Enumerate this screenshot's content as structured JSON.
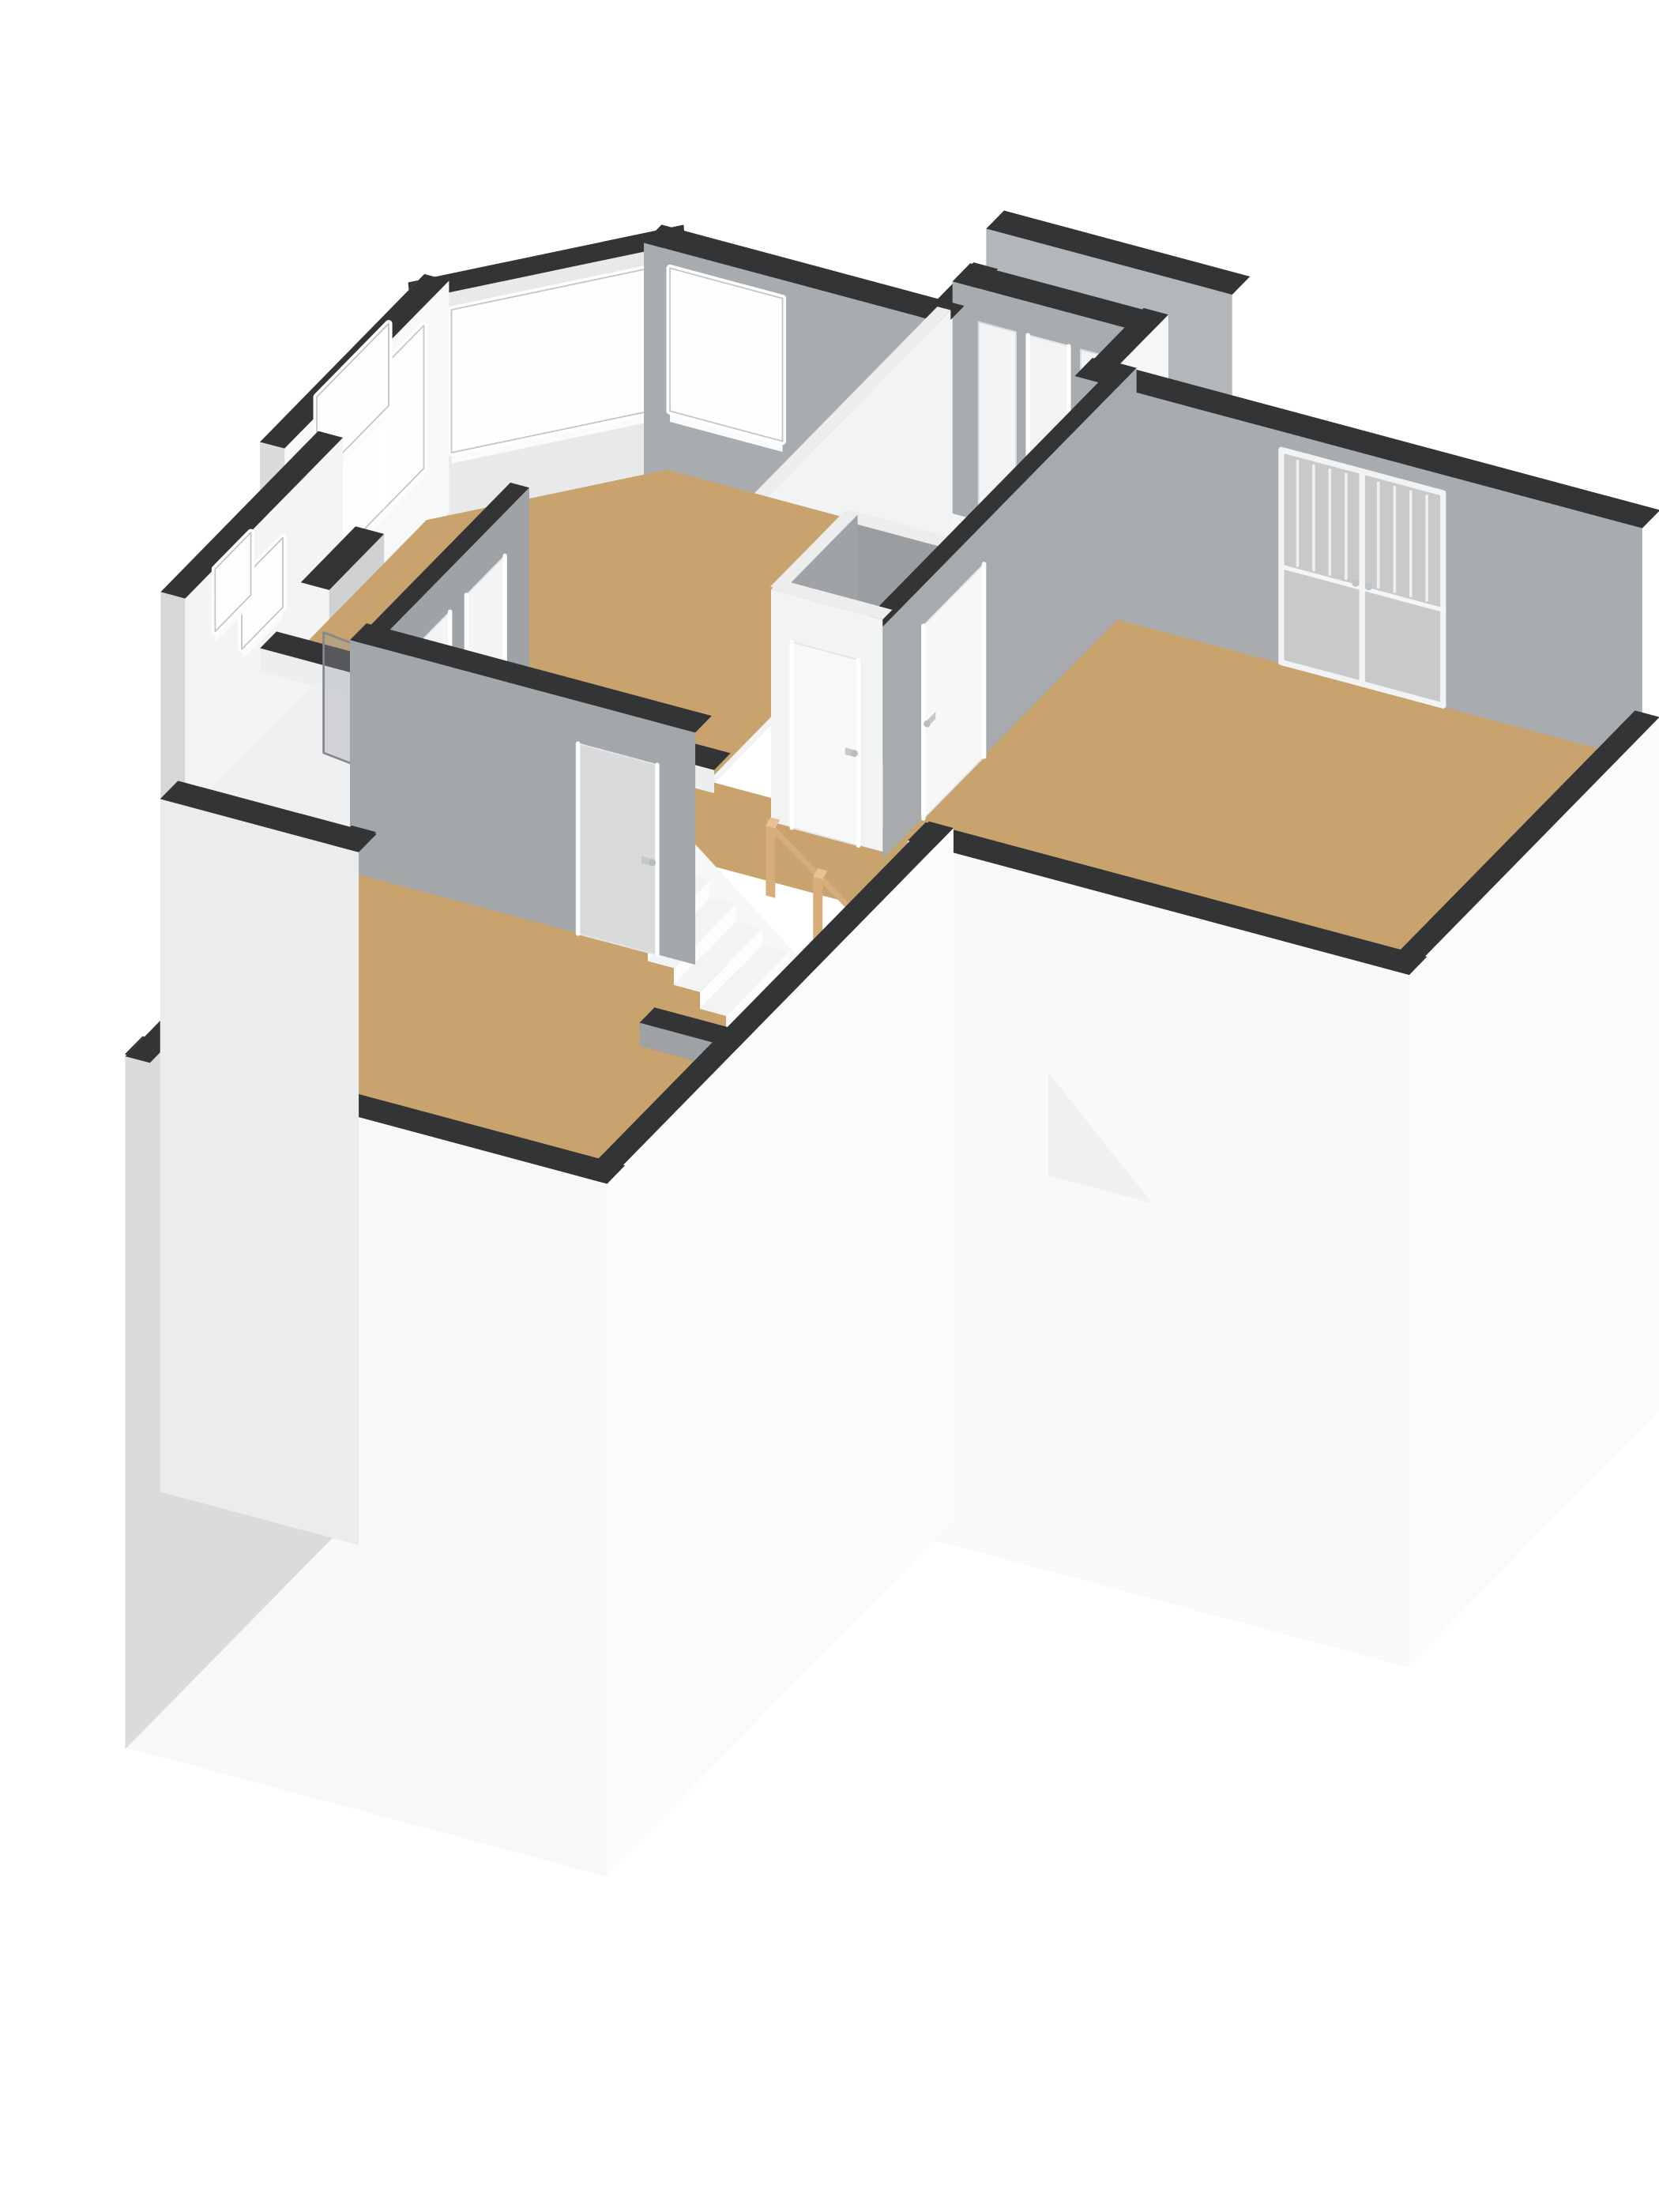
{
  "meta": {
    "description": "3D isometric floor plan rendering of an upper storey: bay-window front room, hallway with doors, toilet with wash basin, master bedroom with French doors, staircase with wooden newel posts, rear bedroom with small window",
    "background": "#ffffff"
  },
  "palette": {
    "capDark": "#323436",
    "wallGray": "#a9acaf",
    "wallGrayDark": "#9b9ea1",
    "wallWhite": "#f6f7f8",
    "floorTan": "#c8a36e",
    "floorLight": "#eef0f1",
    "glass": "#fdfefe",
    "frenchGlass": "#c7c9cb",
    "wood": "#d7ad7c",
    "woodLight": "#e7c294",
    "skirtWhite": "#fafbfc",
    "skirtGray": "#d9dbdd",
    "voidWhite": "#ffffff",
    "frameGray": "#c3c6c8",
    "handleGray": "#c6c9cc"
  },
  "scene": {
    "projection": {
      "axes": {
        "u": [
          0.966,
          0.259
        ],
        "v": [
          -0.7,
          0.714
        ]
      },
      "scale": 68,
      "zscale": 62,
      "origin": [
        358,
        298
      ],
      "wallH": 2.6,
      "skirt": 7.5
    },
    "elements": [
      {
        "t": "wall",
        "id": "neighbor-back-wall",
        "a": [
          4.35,
          -1.2
        ],
        "b": [
          6.65,
          -1.2
        ],
        "th": 0.26,
        "cap": "capDark",
        "neg": {
          "c": "#b4b7ba"
        }
      },
      {
        "t": "wall",
        "id": "closet-west-stub",
        "a": [
          4.5,
          0.05
        ],
        "b": [
          4.5,
          -0.5
        ],
        "th": 0.26,
        "cap": "capDark",
        "pos": {
          "c": "#eef0f1"
        },
        "neg": {
          "c": "#f4f5f6"
        }
      },
      {
        "t": "wall",
        "id": "closet-north-wall",
        "a": [
          4.5,
          -0.5
        ],
        "b": [
          6.3,
          -0.5
        ],
        "th": 0.26,
        "cap": "capDark",
        "neg": {
          "c": "wallGray"
        },
        "openings": [
          {
            "face": "neg",
            "type": "panel",
            "u0": 0.08,
            "u1": 0.3,
            "z0": 0.02,
            "z1": 2.25
          },
          {
            "face": "neg",
            "type": "door",
            "u0": 0.37,
            "u1": 0.61,
            "z0": 0.02,
            "z1": 2.25,
            "fill": "#f2f3f4"
          },
          {
            "face": "neg",
            "type": "panel",
            "u0": 0.68,
            "u1": 0.9,
            "z0": 0.02,
            "z1": 2.25
          }
        ]
      },
      {
        "t": "wall",
        "id": "closet-east-wall",
        "a": [
          6.3,
          -0.5
        ],
        "b": [
          6.3,
          0.2
        ],
        "th": 0.26,
        "cap": "capDark",
        "pos": {
          "c": "#f5f6f7"
        },
        "neg": {
          "c": "wallGrayDark"
        }
      },
      {
        "t": "wall",
        "id": "bay-cant-wall",
        "a": [
          0,
          1.3
        ],
        "b": [
          1.6,
          0
        ],
        "th": 0.26,
        "cap": "capDark",
        "pos": {
          "c": "#eff1f2",
          "z0": -1.2,
          "force": true
        },
        "neg": {
          "c": "#e7e9eb"
        },
        "openings": [
          {
            "face": "neg",
            "type": "window",
            "u0": 0.1,
            "u1": 0.93,
            "z0": 0.82,
            "z1": 2.42,
            "mullions": 1
          }
        ]
      },
      {
        "t": "wall",
        "id": "bay-north-wall",
        "a": [
          1.6,
          0
        ],
        "b": [
          4.5,
          0
        ],
        "th": 0.26,
        "cap": "capDark",
        "neg": {
          "c": "wallGray"
        },
        "openings": [
          {
            "face": "neg",
            "type": "window",
            "u0": 0.05,
            "u1": 0.46,
            "z0": 0.82,
            "z1": 2.42,
            "mullions": 1
          }
        ]
      },
      {
        "t": "wall",
        "id": "bay-west-wall",
        "a": [
          0,
          3.4
        ],
        "b": [
          0,
          1.3
        ],
        "th": 0.26,
        "cap": "capDark",
        "pos": {
          "c": "skirtGray",
          "skirt": true,
          "force": true
        },
        "neg": {
          "c": "#f7f8f9"
        },
        "openings": [
          {
            "face": "neg",
            "type": "window",
            "u0": 0.3,
            "u1": 0.88,
            "z0": 0.82,
            "z1": 2.42,
            "mullions": 1
          },
          {
            "face": "pos",
            "type": "window",
            "u0": 0.34,
            "u1": 0.84,
            "z0": 1.5,
            "z1": 2.42,
            "fill": "glass",
            "force": true
          }
        ]
      },
      {
        "t": "wall",
        "id": "annex-west-wall",
        "a": [
          0.4,
          5.4
        ],
        "b": [
          0.4,
          3.4
        ],
        "th": 0.26,
        "cap": "capDark",
        "pos": {
          "c": "#d5d7d9",
          "skirt": true,
          "force": true
        },
        "neg": {
          "c": "#f3f4f5"
        },
        "openings": [
          {
            "face": "neg",
            "type": "window",
            "u0": 0.32,
            "u1": 0.62,
            "z0": 1.42,
            "z1": 2.2
          },
          {
            "face": "pos",
            "type": "window",
            "u0": 0.34,
            "u1": 0.6,
            "z0": 1.5,
            "z1": 2.2,
            "fill": "glass",
            "force": true
          }
        ]
      },
      {
        "t": "wall",
        "id": "chimney-left",
        "a": [
          -0.2,
          2.0
        ],
        "b": [
          -0.2,
          2.5
        ],
        "th": 0.3,
        "cap": "capDark",
        "mode": "near",
        "pos": {
          "c": "#cfd1d3",
          "z0": -1.1,
          "force": true
        }
      },
      {
        "t": "wall",
        "id": "bay-room-east-wall",
        "a": [
          4.5,
          0
        ],
        "b": [
          4.5,
          3.4
        ],
        "th": 0.14,
        "cap": "#ededee",
        "pos": {
          "c": "#f2f3f4"
        },
        "neg": {
          "c": "#a4a7aa"
        }
      },
      {
        "t": "floor",
        "id": "floor-closet-corridor",
        "pts": [
          [
            4.5,
            -0.5
          ],
          [
            6.3,
            -0.5
          ],
          [
            6.3,
            2.1
          ],
          [
            4.5,
            2.1
          ]
        ],
        "c": "#b6b9bb"
      },
      {
        "t": "floor",
        "id": "floor-bay-room",
        "pts": [
          [
            0,
            1.3
          ],
          [
            1.6,
            0
          ],
          [
            4.5,
            0
          ],
          [
            4.5,
            3.4
          ],
          [
            0,
            3.4
          ]
        ],
        "c": "floorTan"
      },
      {
        "t": "floor",
        "id": "floor-right-room",
        "pts": [
          [
            6.5,
            0.2
          ],
          [
            12,
            0.2
          ],
          [
            12,
            3.6
          ],
          [
            6.5,
            3.6
          ]
        ],
        "c": "floorTan"
      },
      {
        "t": "floor",
        "id": "floor-toilet",
        "pts": [
          [
            5.4,
            2.6
          ],
          [
            6.5,
            2.6
          ],
          [
            6.5,
            3.6
          ],
          [
            5.4,
            3.6
          ]
        ],
        "c": "#edeff0"
      },
      {
        "t": "floor",
        "id": "floor-hallway",
        "pts": [
          [
            2.4,
            3.4
          ],
          [
            6.5,
            3.4
          ],
          [
            6.5,
            3.6
          ],
          [
            7.0,
            3.6
          ],
          [
            7.0,
            5.4
          ],
          [
            2.4,
            5.4
          ]
        ],
        "c": "floorTan"
      },
      {
        "t": "floor",
        "id": "floor-bathroom",
        "pts": [
          [
            0.4,
            3.4
          ],
          [
            2.4,
            3.4
          ],
          [
            2.4,
            5.4
          ],
          [
            0.4,
            5.4
          ]
        ],
        "c": "floorLight"
      },
      {
        "t": "floor",
        "id": "floor-back-room",
        "pts": [
          [
            2.2,
            5.4
          ],
          [
            7.0,
            5.4
          ],
          [
            7.0,
            8.4
          ],
          [
            2.2,
            8.4
          ]
        ],
        "c": "floorTan"
      },
      {
        "t": "floor",
        "id": "stairwell-void",
        "pts": [
          [
            4.95,
            4.35
          ],
          [
            6.95,
            4.35
          ],
          [
            6.95,
            5.4
          ],
          [
            4.95,
            5.4
          ]
        ],
        "c": "voidWhite"
      },
      {
        "t": "wall",
        "id": "right-room-north-wall",
        "a": [
          6.3,
          0.2
        ],
        "b": [
          12,
          0.2
        ],
        "th": 0.26,
        "cap": "capDark",
        "neg": {
          "c": "wallGray"
        },
        "openings": [
          {
            "face": "neg",
            "type": "french",
            "u0": 0.36,
            "u1": 0.66,
            "z0": 0.04,
            "z1": 2.42
          }
        ]
      },
      {
        "t": "wall",
        "id": "bay-south-wall",
        "a": [
          0,
          3.4
        ],
        "b": [
          4.5,
          3.4
        ],
        "th": 0.24,
        "cap": "capDark",
        "mode": "near",
        "neg": {
          "c": "#eceeef"
        }
      },
      {
        "t": "wall",
        "id": "toilet-north-wall",
        "a": [
          5.4,
          2.6
        ],
        "b": [
          6.5,
          2.6
        ],
        "th": 0.14,
        "cap": "#ededee",
        "neg": {
          "c": "wallGrayDark"
        }
      },
      {
        "t": "wall",
        "id": "right-room-west-wall",
        "a": [
          6.5,
          0.2
        ],
        "b": [
          6.5,
          3.6
        ],
        "th": 0.2,
        "cap": "capDark",
        "pos": {
          "c": "#a8abae"
        },
        "openings": [
          {
            "face": "pos",
            "type": "door",
            "u0": 0.62,
            "u1": 0.88,
            "z0": 0.02,
            "z1": 2.18,
            "fill": "#f6f7f8",
            "handle": true
          }
        ]
      },
      {
        "t": "wall",
        "id": "toilet-west-wall",
        "a": [
          5.4,
          2.6
        ],
        "b": [
          5.4,
          3.6
        ],
        "th": 0.14,
        "cap": "#ededee",
        "pos": {
          "c": "#a0a3a6"
        }
      },
      {
        "t": "sink",
        "id": "sink",
        "x0": 5.49,
        "x1": 5.91,
        "y0": 2.84,
        "y1": 3.3,
        "zTop": 1.0,
        "zBot": 0.8
      },
      {
        "t": "wall",
        "id": "toilet-south-wall",
        "a": [
          5.4,
          3.6
        ],
        "b": [
          6.5,
          3.6
        ],
        "th": 0.14,
        "cap": "#ededee",
        "neg": {
          "c": "#f2f3f4"
        },
        "openings": [
          {
            "face": "neg",
            "type": "door",
            "u0": 0.18,
            "u1": 0.82,
            "z0": 0.02,
            "z1": 2.1,
            "fill": "#f7f8f9",
            "handle": true
          }
        ]
      },
      {
        "t": "partition",
        "id": "shower-screen",
        "a": [
          1.05,
          4.25
        ],
        "b": [
          2.37,
          4.4
        ],
        "h": 1.35
      },
      {
        "t": "wall",
        "id": "hall-west-wall",
        "a": [
          2.4,
          3.4
        ],
        "b": [
          2.4,
          5.4
        ],
        "th": 0.2,
        "cap": "capDark",
        "pos": {
          "c": "#a0a3a6"
        },
        "neg": {
          "c": "#eceded"
        },
        "openings": [
          {
            "face": "pos",
            "type": "door",
            "u0": 0.12,
            "u1": 0.4,
            "z0": 0.02,
            "z1": 2.15,
            "fill": "#f4f5f6",
            "handle": true
          },
          {
            "face": "pos",
            "type": "door",
            "u0": 0.52,
            "u1": 0.8,
            "z0": 0.02,
            "z1": 2.15,
            "fill": "#f4f5f6",
            "handle": true
          }
        ]
      },
      {
        "t": "stairs",
        "id": "staircase"
      },
      {
        "t": "wall",
        "id": "landing-south-wall",
        "a": [
          2.4,
          5.4
        ],
        "b": [
          5.75,
          5.4
        ],
        "th": 0.24,
        "cap": "capDark",
        "neg": {
          "c": "#a4a7aa"
        },
        "openings": [
          {
            "face": "neg",
            "type": "door",
            "u0": 0.68,
            "u1": 0.93,
            "z0": 0.02,
            "z1": 2.15,
            "fill": "#d8dadc",
            "handle": true
          }
        ]
      },
      {
        "t": "wall",
        "id": "chimney-stub-wall",
        "a": [
          6.25,
          6.5
        ],
        "b": [
          7.0,
          6.5
        ],
        "th": 0.22,
        "cap": "capDark",
        "mode": "near",
        "neg": {
          "c": "#9fa2a5"
        }
      },
      {
        "t": "wall",
        "id": "right-room-se-wall",
        "a": [
          12,
          0.2
        ],
        "b": [
          12,
          3.6
        ],
        "th": 0.26,
        "cap": "capDark",
        "mode": "near",
        "pos": {
          "c": "skirtWhite",
          "skirt": true
        },
        "neg": {
          "c": "#eef0f1"
        }
      },
      {
        "t": "wall",
        "id": "right-room-south-wall",
        "a": [
          12,
          3.6
        ],
        "b": [
          7.0,
          3.6
        ],
        "th": 0.26,
        "cap": "capDark",
        "mode": "near",
        "pos": {
          "c": "#f8f9fa",
          "skirt": true
        }
      },
      {
        "t": "wedge",
        "id": "facade-wedge",
        "pts": [
          [
            8.35,
            3.75,
            -1.9
          ],
          [
            9.45,
            3.75,
            -3.05
          ],
          [
            8.35,
            3.75,
            -3.05
          ]
        ],
        "c": "#eef0f2"
      },
      {
        "t": "wall",
        "id": "back-block-east-wall",
        "a": [
          7.0,
          3.6
        ],
        "b": [
          7.0,
          8.4
        ],
        "th": 0.26,
        "cap": "capDark",
        "mode": "near",
        "pos": {
          "c": "skirtWhite",
          "skirt": true
        }
      },
      {
        "t": "wall",
        "id": "back-room-south-wall",
        "a": [
          7.0,
          8.4
        ],
        "b": [
          2.2,
          8.4
        ],
        "th": 0.26,
        "cap": "capDark",
        "mode": "near",
        "pos": {
          "c": "#f7f8f9",
          "skirt": true
        }
      },
      {
        "t": "wall",
        "id": "back-room-west-wall",
        "a": [
          2.2,
          8.4
        ],
        "b": [
          2.2,
          5.4
        ],
        "th": 0.26,
        "cap": "capDark",
        "mode": "near",
        "pos": {
          "c": "skirtGray",
          "skirt": true,
          "force": true
        },
        "openings": [
          {
            "face": "pos",
            "type": "window",
            "u0": 0.14,
            "u1": 0.42,
            "z0": 0.55,
            "z1": 2.05,
            "fill": "floorTan",
            "force": true
          }
        ]
      },
      {
        "t": "wall",
        "id": "annex-south-wall",
        "a": [
          2.2,
          5.4
        ],
        "b": [
          0.4,
          5.4
        ],
        "th": 0.26,
        "cap": "capDark",
        "mode": "near",
        "pos": {
          "c": "#eaeced",
          "skirt": true
        }
      }
    ]
  }
}
